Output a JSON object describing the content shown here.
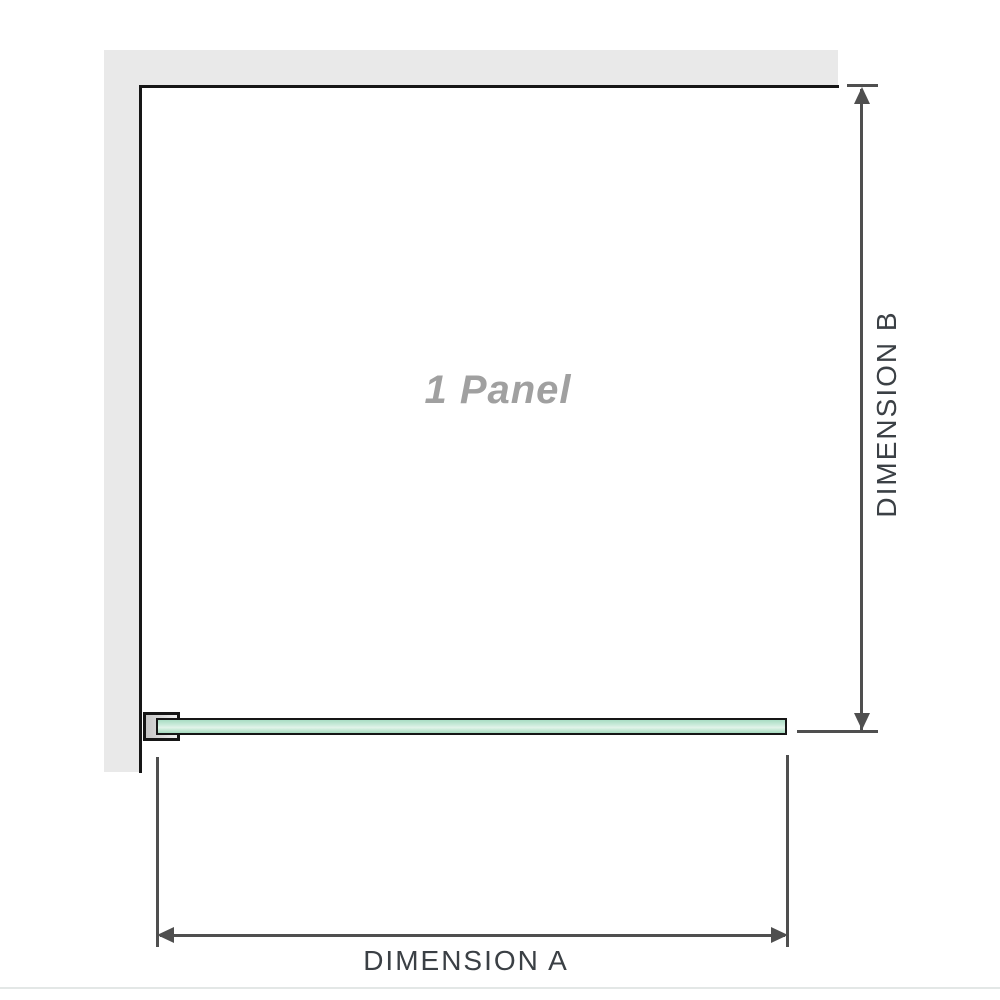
{
  "diagram": {
    "panel_label": "1 Panel",
    "dimension_a_label": "DIMENSION A",
    "dimension_b_label": "DIMENSION B"
  },
  "colors": {
    "wall-gray": "#e9e9e9",
    "outline-black": "#161616",
    "dim-line": "#4f4f4f",
    "dim-text": "#3b4045",
    "glass-green": "#a9ddc3",
    "glass-green-light": "#e2f4ea",
    "label-gray": "#a0a0a0",
    "divider": "#e3e7e6"
  }
}
